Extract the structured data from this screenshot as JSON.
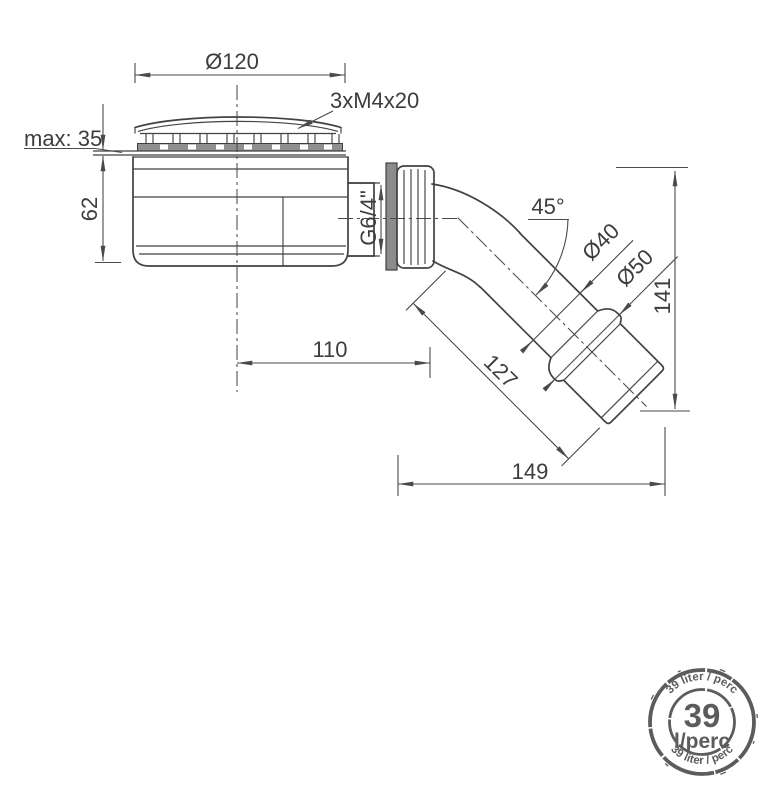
{
  "drawing": {
    "labels": {
      "top_diameter": "Ø120",
      "screws": "3xM4x20",
      "max_thickness": "max: 35",
      "body_height": "62",
      "thread_size": "G6/4\"",
      "elbow_angle": "45°",
      "pipe_diameter": "Ø40",
      "outlet_diameter": "Ø50",
      "total_height": "141",
      "horizontal_offset": "110",
      "outlet_length": "127",
      "total_length": "149"
    },
    "line_color": "#424242",
    "dimension_color": "#4a4a4a"
  },
  "badge": {
    "flow_value": "39",
    "flow_unit": "l/perc",
    "arc_text_top": "39 liter / perc",
    "arc_text_bottom": "39 liter / perc",
    "color": "#5b5c5e"
  }
}
